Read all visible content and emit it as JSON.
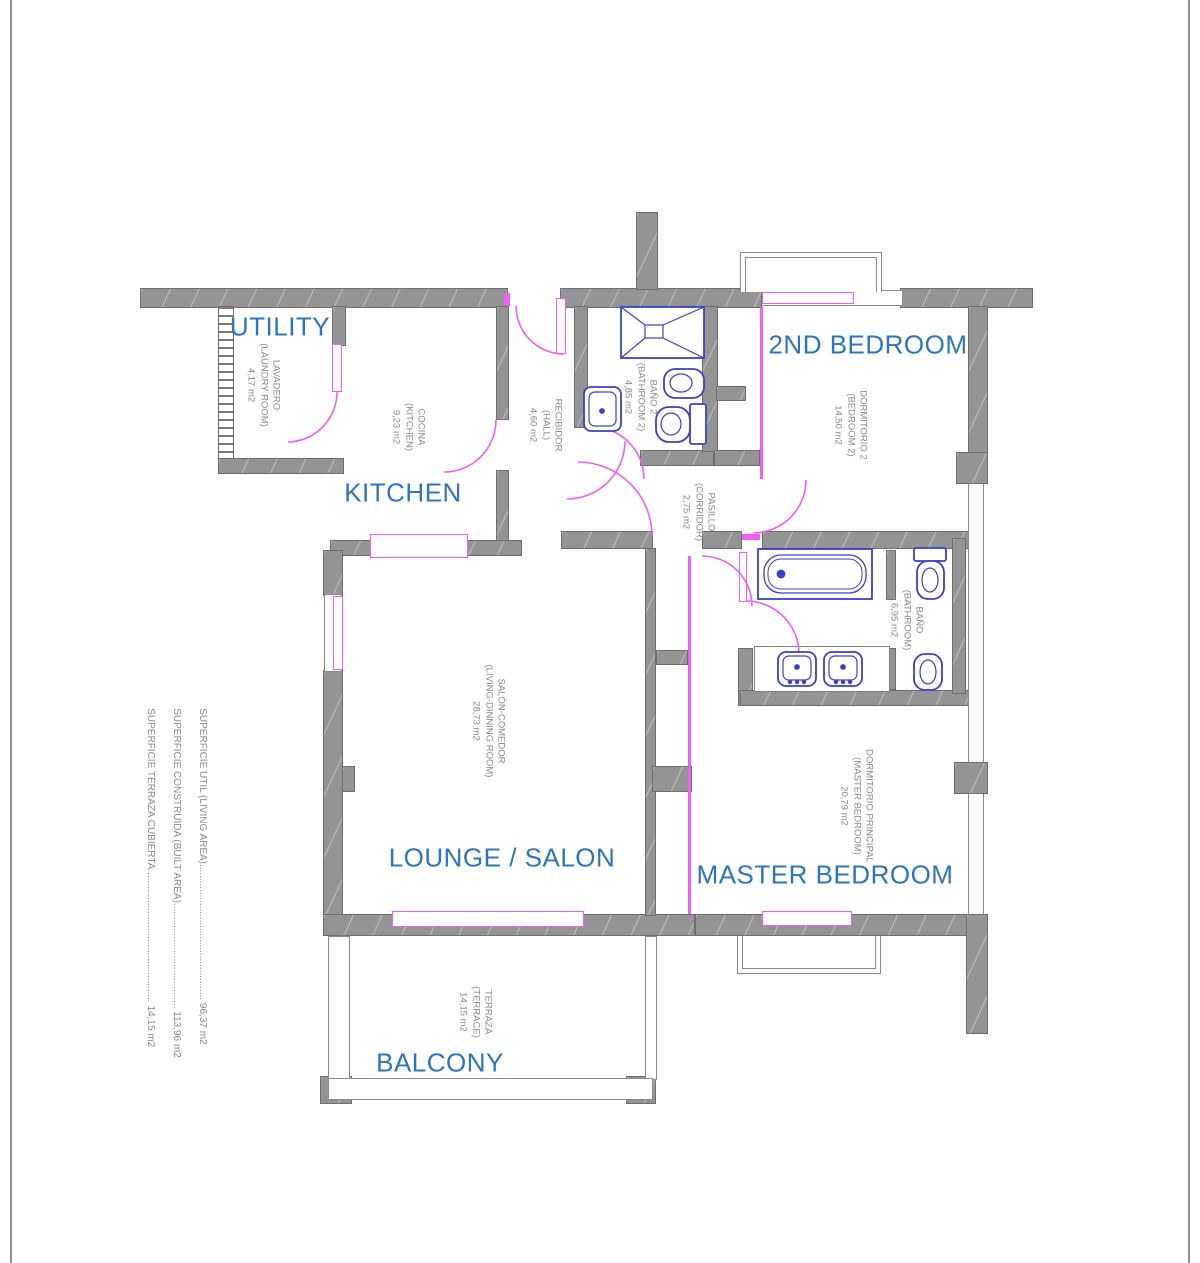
{
  "colors": {
    "wall": "#949494",
    "door_window": "#ee5ff2",
    "fixture": "#3c3fc8",
    "room_label": "#2f74ba",
    "small_label": "#8a8a8a"
  },
  "rooms": [
    {
      "id": "utility",
      "label": "UTILITY",
      "sub": [
        "LAVADERO",
        "(LAUNDRY ROOM)",
        "4,17 m2"
      ]
    },
    {
      "id": "kitchen",
      "label": "KITCHEN",
      "sub": [
        "COCINA",
        "(KITCHEN)",
        "9,23 m2"
      ]
    },
    {
      "id": "hall",
      "label": "",
      "sub": [
        "RECIBIDOR",
        "(HALL)",
        "4,60 m2"
      ]
    },
    {
      "id": "bathroom2",
      "label": "",
      "sub": [
        "BAÑO 2",
        "(BATHROOM 2)",
        "4,85 m2"
      ]
    },
    {
      "id": "bedroom2",
      "label": "2ND BEDROOM",
      "sub": [
        "DORMITORIO 2",
        "(BEDROOM 2)",
        "14,50 m2"
      ]
    },
    {
      "id": "corridor",
      "label": "",
      "sub": [
        "PASILLO",
        "(CORRIDOR)",
        "2,75 m2"
      ]
    },
    {
      "id": "bathroom",
      "label": "",
      "sub": [
        "BAÑO",
        "(BATHROOM)",
        "6,95 m2"
      ]
    },
    {
      "id": "lounge",
      "label": "LOUNGE / SALON",
      "sub": [
        "SALÓN-COMEDOR",
        "(LIVING-DINNING ROOM)",
        "28,73 m2"
      ]
    },
    {
      "id": "master",
      "label": "MASTER BEDROOM",
      "sub": [
        "DORMITORIO PRINCIPAL",
        "(MASTER BEDROOM)",
        "20,79 m2"
      ]
    },
    {
      "id": "balcony",
      "label": "BALCONY",
      "sub": [
        "TERRAZA",
        "(TERRACE)",
        "14,15 m2"
      ]
    }
  ],
  "summary": [
    "SUPERFICIE UTIL (LIVING AREA)................................................. 96,37 m2",
    "SUPERFICIE CONSTRUIDA (BUILT AREA)...................................... 113,96 m2",
    "SUPERFICIE TERRAZA CUBIERTA................................................ 14,15 m2"
  ]
}
